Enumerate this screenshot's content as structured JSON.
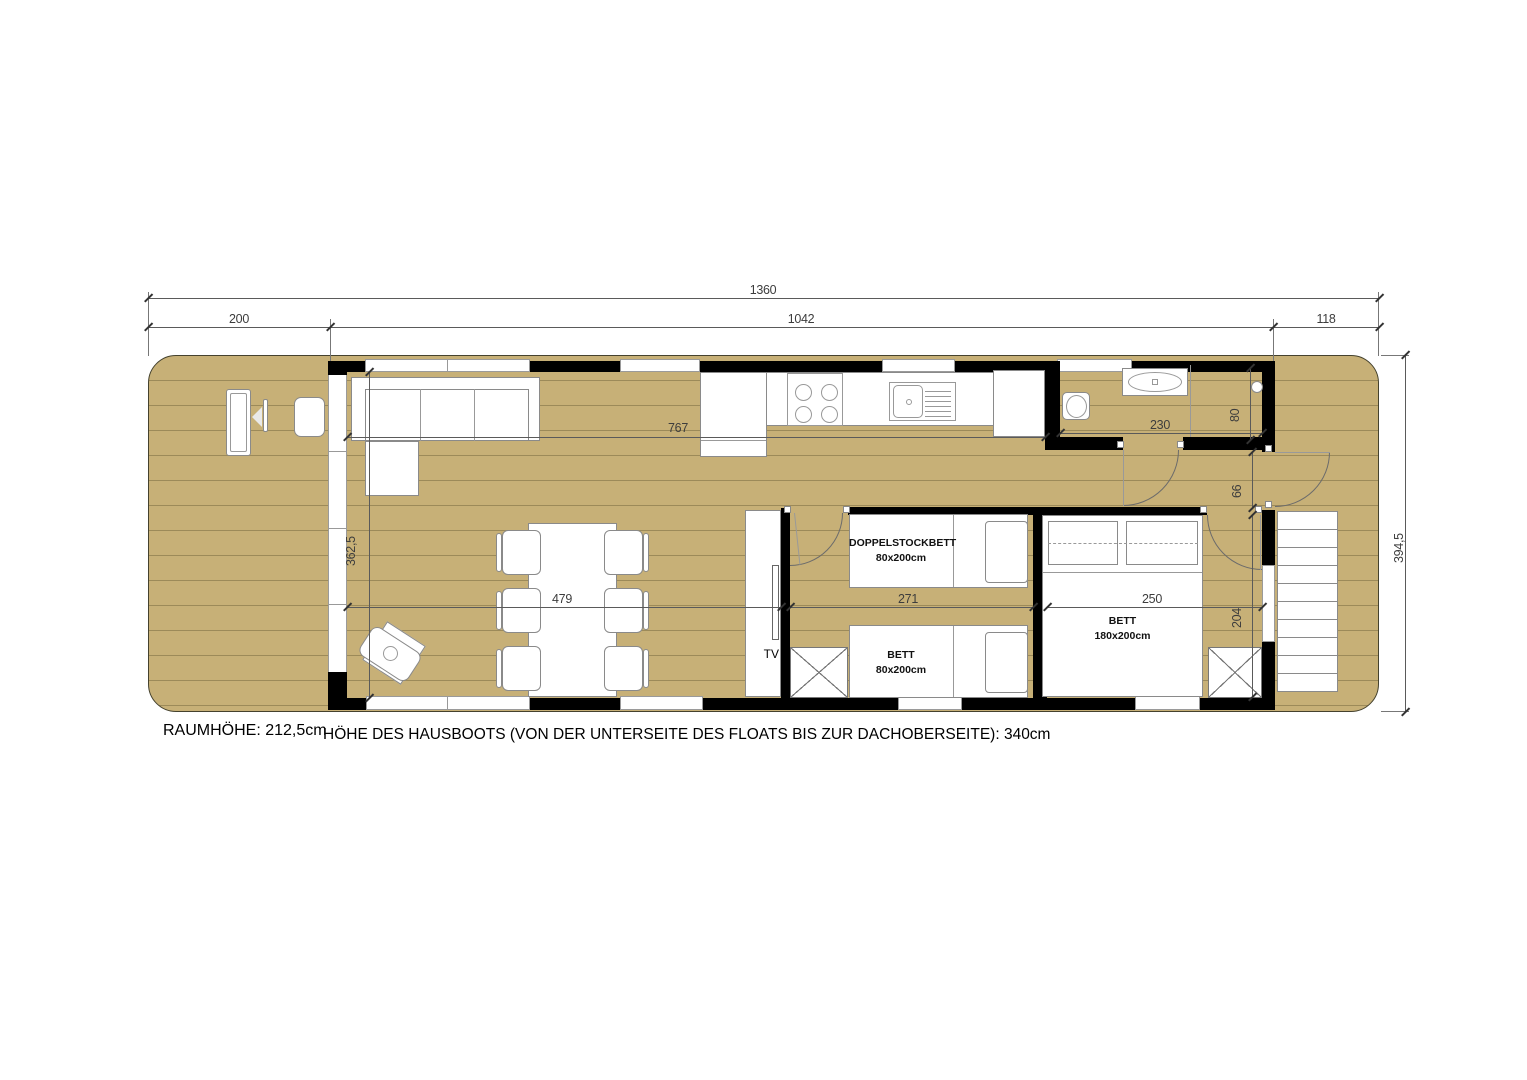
{
  "plan": {
    "dims": {
      "total": "1360",
      "terrace": "200",
      "cabin": "1042",
      "rear_deck": "118",
      "overall_width": "394,5",
      "kitchen_run": "767",
      "living_width": "362,5",
      "living_length": "479",
      "kids_room": "271",
      "master_room": "250",
      "bathroom": "230",
      "bathroom_depth": "80",
      "hallway": "66",
      "master_depth": "204"
    },
    "labels": {
      "tv": "TV",
      "bunk_name": "DOPPELSTOCKBETT",
      "bunk_size": "80x200cm",
      "bett_name": "BETT",
      "bett_size": "80x200cm",
      "master_name": "BETT",
      "master_size": "180x200cm"
    },
    "notes": {
      "room_height": "RAUMHÖHE: 212,5cm",
      "boat_height": "HÖHE DES HAUSBOOTS (VON DER UNTERSEITE DES FLOATS BIS ZUR DACHOBERSEITE): 340cm"
    },
    "colors": {
      "deck": "#c7b077",
      "wall": "#000000",
      "furniture_outline": "#8a8a8a",
      "dimension_text": "#3d3d3d"
    }
  }
}
